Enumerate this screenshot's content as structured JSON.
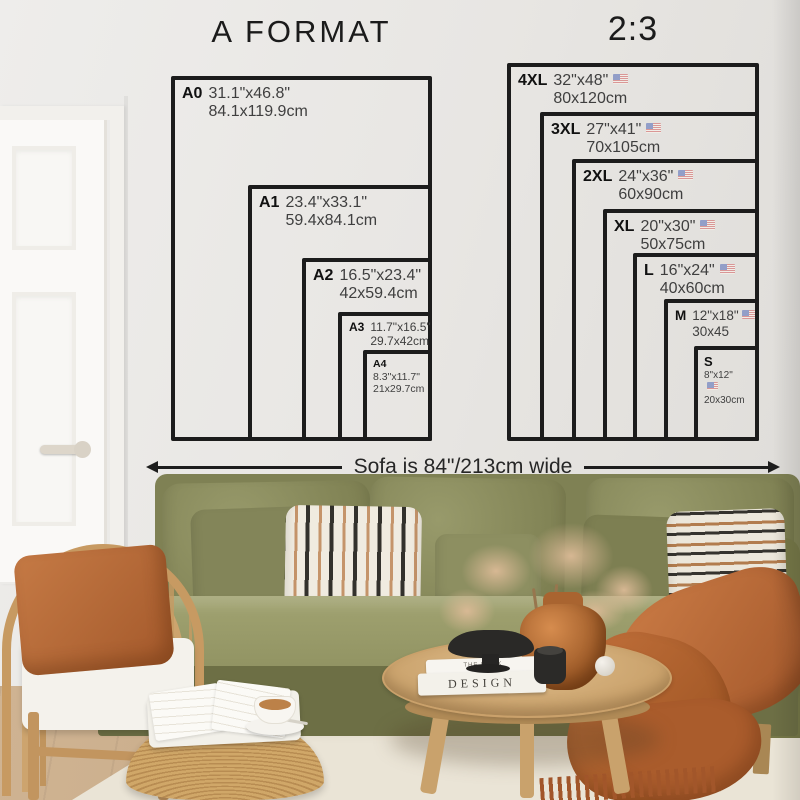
{
  "a_format": {
    "title": "A FORMAT",
    "sizes": [
      {
        "label": "A0",
        "inches": "31.1\"x46.8\"",
        "cm": "84.1x119.9cm"
      },
      {
        "label": "A1",
        "inches": "23.4\"x33.1\"",
        "cm": "59.4x84.1cm"
      },
      {
        "label": "A2",
        "inches": "16.5\"x23.4\"",
        "cm": "42x59.4cm"
      },
      {
        "label": "A3",
        "inches": "11.7\"x16.5\"",
        "cm": "29.7x42cm"
      },
      {
        "label": "A4",
        "inches": "8.3\"x11.7\"",
        "cm": "21x29.7cm"
      }
    ]
  },
  "ratio_2_3": {
    "title": "2:3",
    "sizes": [
      {
        "label": "4XL",
        "inches": "32\"x48\"",
        "cm": "80x120cm"
      },
      {
        "label": "3XL",
        "inches": "27\"x41\"",
        "cm": "70x105cm"
      },
      {
        "label": "2XL",
        "inches": "24\"x36\"",
        "cm": "60x90cm"
      },
      {
        "label": "XL",
        "inches": "20\"x30\"",
        "cm": "50x75cm"
      },
      {
        "label": "L",
        "inches": "16\"x24\"",
        "cm": "40x60cm"
      },
      {
        "label": "M",
        "inches": "12\"x18\"",
        "cm": "30x45"
      },
      {
        "label": "S",
        "inches": "8\"x12\"",
        "cm": "20x30cm"
      }
    ]
  },
  "sofa_note": "Sofa is 84\"/213cm wide",
  "scene": {
    "book_spine_top": "THE BOOK",
    "book_spine_title": "DESIGN"
  },
  "icons": {
    "flag": "us-flag"
  },
  "colors": {
    "line": "#1c1c1c",
    "wall": "#e9e7e3",
    "sofa_olive": "#8a8c5e",
    "rust": "#b06a3a",
    "rattan": "#c89c66",
    "table_wood": "#cfa873"
  }
}
